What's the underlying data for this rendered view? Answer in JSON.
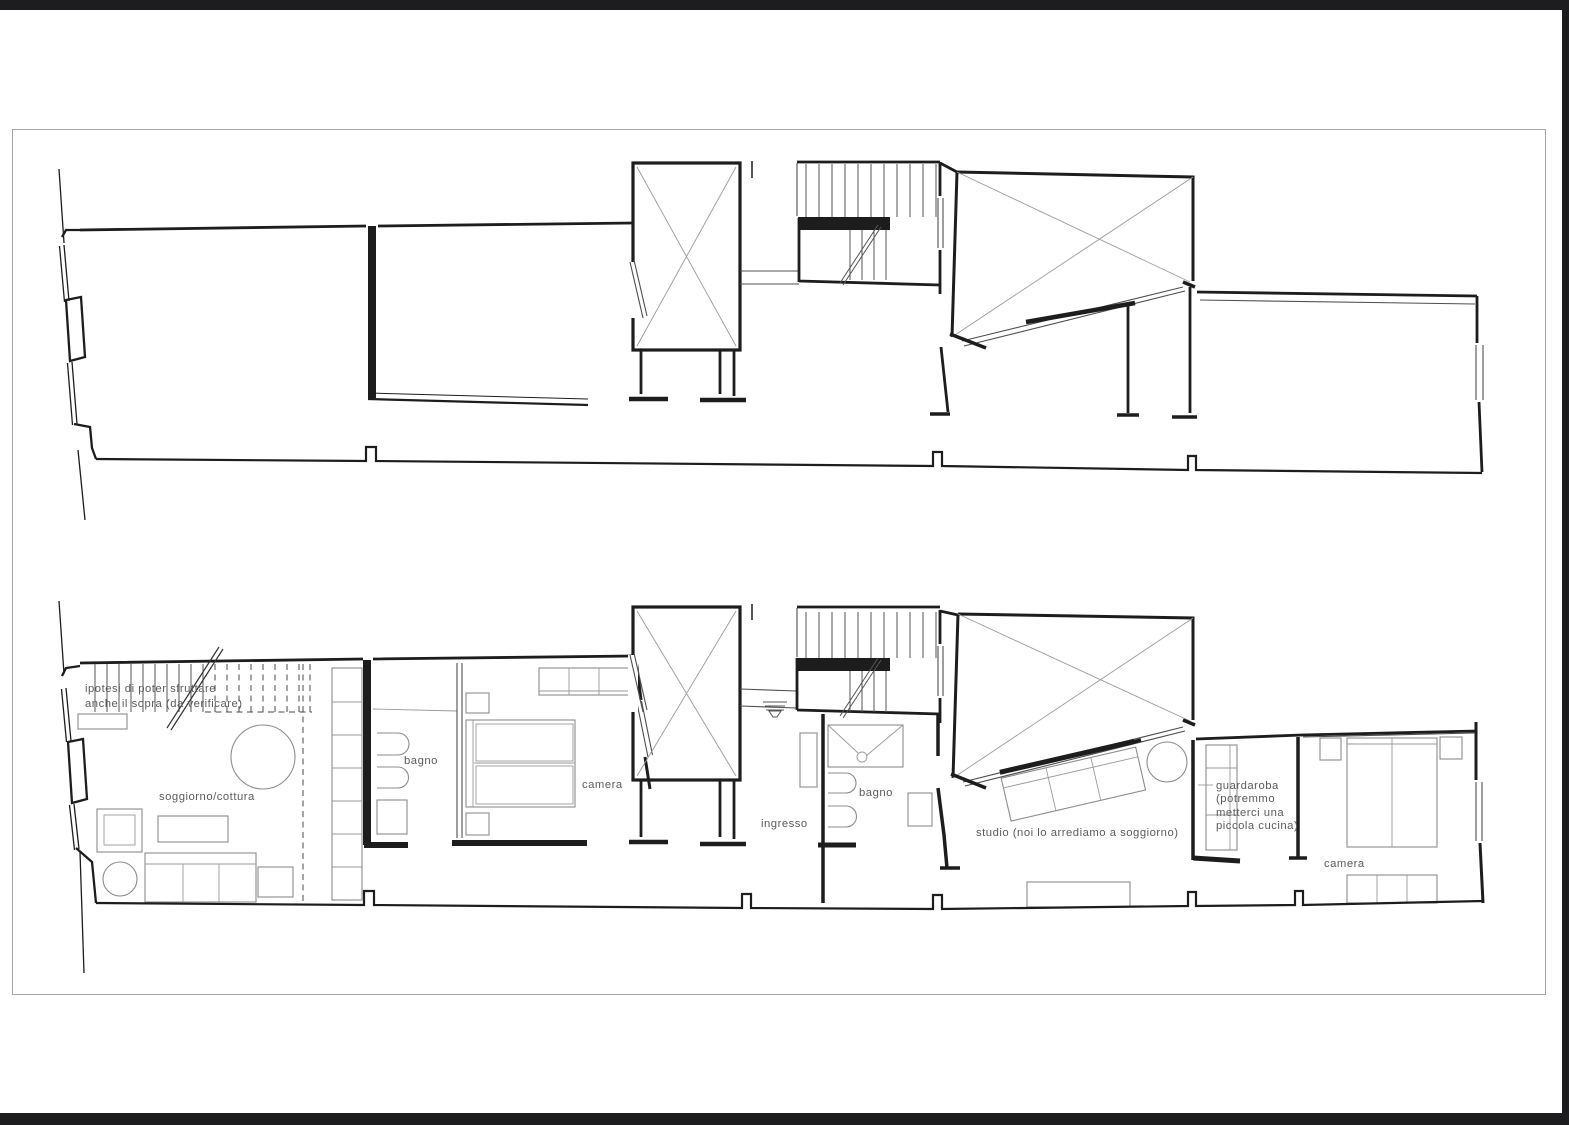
{
  "document": {
    "type": "architectural floor plan sheet",
    "plans_shown": 2
  },
  "colors": {
    "background": "#ffffff",
    "frame_bars": "#1d1d20",
    "page_border": "#a6a6a6",
    "ink": "#1d1d1d",
    "furniture_line": "#8c8c8c",
    "label_text": "#5c5c5c"
  },
  "icons": {
    "shaft_cross": "x-cross-box-icon",
    "void_cross": "x-cross-void-icon",
    "stair_direction": "diagonal-arrow-line-icon",
    "sink": "sink-icon",
    "shower_drain": "shower-drain-icon"
  },
  "plans": {
    "upper": {
      "description_labels": []
    },
    "lower": {
      "annotation": {
        "line1": "ipotesi di poter sfruttare",
        "line2": "anche il sopra (da verificare)"
      },
      "rooms": {
        "soggiorno": "soggiorno/cottura",
        "bagno_left": "bagno",
        "camera_left": "camera",
        "ingresso": "ingresso",
        "bagno_right": "bagno",
        "studio": "studio (noi lo arrediamo a soggiorno)",
        "guardaroba": {
          "line1": "guardaroba",
          "line2": "(potremmo",
          "line3": "metterci una",
          "line4": "piccola cucina)"
        },
        "camera_right": "camera"
      }
    }
  }
}
